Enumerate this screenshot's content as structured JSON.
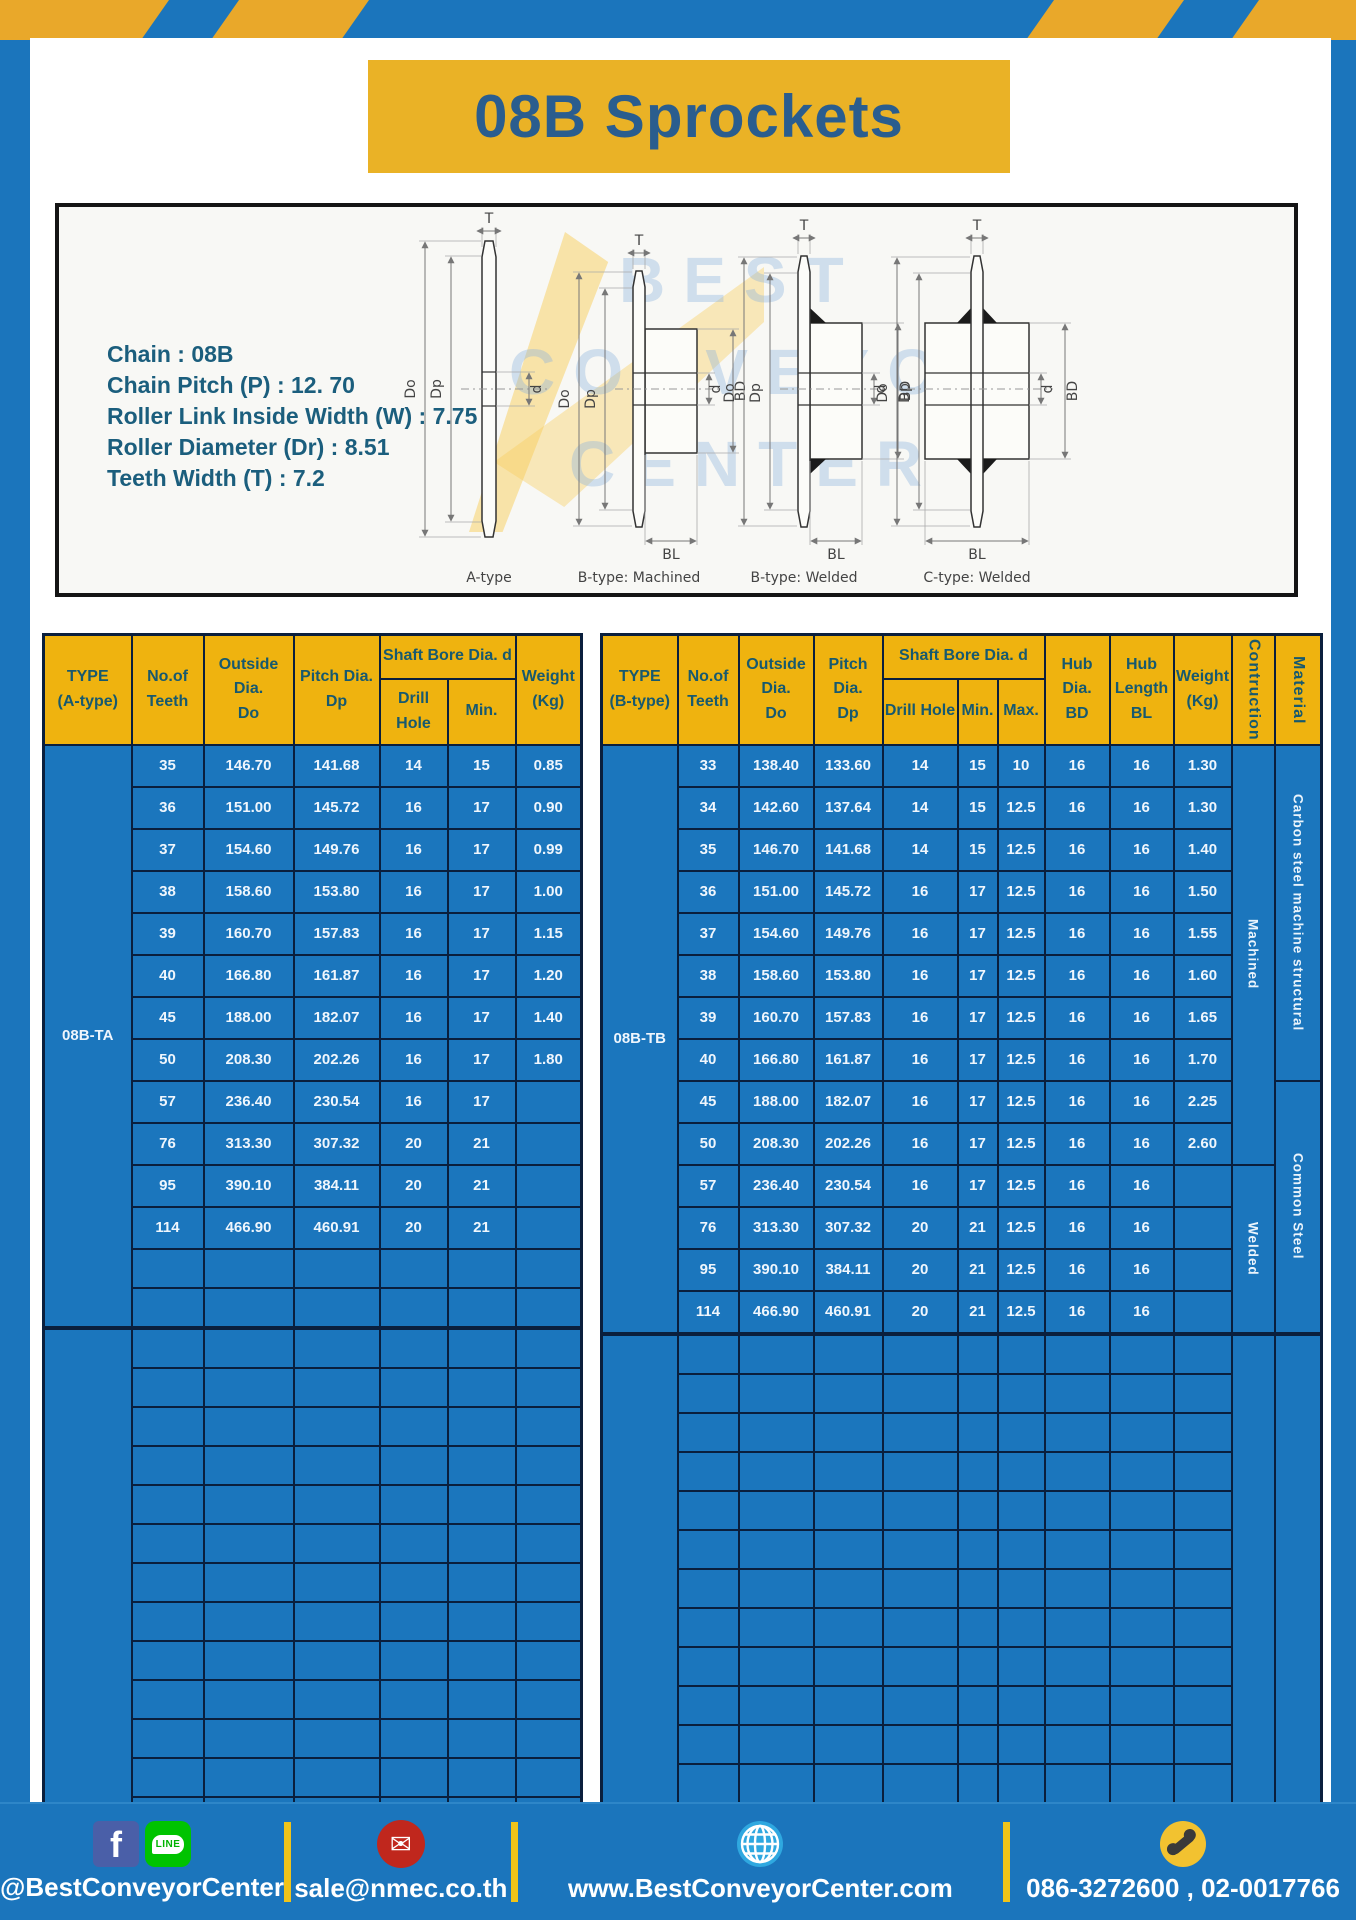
{
  "title": "08B Sprockets",
  "colors": {
    "frame_blue": "#1B75BC",
    "accent_yellow": "#EAB226",
    "table_header_yellow": "#EFB30F",
    "table_body_blue": "#1B76BD",
    "table_border_navy": "#0A1F3D",
    "title_blue": "#2A5D8E",
    "spec_teal": "#1B5E7D",
    "footer_divider_yellow": "#F0C419"
  },
  "specs": {
    "lines": [
      "Chain  : 08B",
      "Chain Pitch (P)  :  12. 70",
      "Roller Link Inside Width (W)  :  7.75",
      "Roller Diameter (Dr)  : 8.51",
      "Teeth Width (T)  :  7.2"
    ]
  },
  "diagram": {
    "captions": [
      "A-type",
      "B-type: Machined",
      "B-type: Welded",
      "C-type: Welded"
    ],
    "dims": {
      "t": "T",
      "do_": "Do",
      "dp": "Dp",
      "d": "d",
      "bd": "BD",
      "bl": "BL"
    },
    "watermark": [
      "BEST",
      "CONVEYOR",
      "CENTER"
    ]
  },
  "left_table": {
    "cols": 6,
    "headers": {
      "type": "TYPE\n(A-type)",
      "teeth": "No.of\nTeeth",
      "outside": "Outside\nDia.\nDo",
      "pitch": "Pitch Dia.\nDp",
      "shaft": "Shaft Bore Dia. d",
      "drill": "Drill Hole",
      "min": "Min.",
      "weight": "Weight\n(Kg)"
    },
    "sections": [
      {
        "type_label": "08B-TA",
        "empty_rows": 2,
        "rows": [
          [
            "35",
            "146.70",
            "141.68",
            "14",
            "15",
            "0.85"
          ],
          [
            "36",
            "151.00",
            "145.72",
            "16",
            "17",
            "0.90"
          ],
          [
            "37",
            "154.60",
            "149.76",
            "16",
            "17",
            "0.99"
          ],
          [
            "38",
            "158.60",
            "153.80",
            "16",
            "17",
            "1.00"
          ],
          [
            "39",
            "160.70",
            "157.83",
            "16",
            "17",
            "1.15"
          ],
          [
            "40",
            "166.80",
            "161.87",
            "16",
            "17",
            "1.20"
          ],
          [
            "45",
            "188.00",
            "182.07",
            "16",
            "17",
            "1.40"
          ],
          [
            "50",
            "208.30",
            "202.26",
            "16",
            "17",
            "1.80"
          ],
          [
            "57",
            "236.40",
            "230.54",
            "16",
            "17",
            ""
          ],
          [
            "76",
            "313.30",
            "307.32",
            "20",
            "21",
            ""
          ],
          [
            "95",
            "390.10",
            "384.11",
            "20",
            "21",
            ""
          ],
          [
            "114",
            "466.90",
            "460.91",
            "20",
            "21",
            ""
          ]
        ]
      },
      {
        "type_label": "",
        "empty_rows": 13,
        "rows": []
      }
    ]
  },
  "right_table": {
    "cols": 9,
    "headers": {
      "type": "TYPE\n(B-type)",
      "teeth": "No.of\nTeeth",
      "outside": "Outside\nDia.\nDo",
      "pitch": "Pitch Dia.\nDp",
      "shaft": "Shaft Bore Dia. d",
      "drill": "Drill Hole",
      "min": "Min.",
      "max": "Max.",
      "hub_dia": "Hub Dia.\nBD",
      "hub_len": "Hub\nLength\nBL",
      "weight": "Weight\n(Kg)",
      "construction": "Contruction",
      "material": "Material"
    },
    "sections": [
      {
        "type_label": "08B-TB",
        "empty_rows": 0,
        "rows": [
          [
            "33",
            "138.40",
            "133.60",
            "14",
            "15",
            "10",
            "16",
            "16",
            "1.30"
          ],
          [
            "34",
            "142.60",
            "137.64",
            "14",
            "15",
            "12.5",
            "16",
            "16",
            "1.30"
          ],
          [
            "35",
            "146.70",
            "141.68",
            "14",
            "15",
            "12.5",
            "16",
            "16",
            "1.40"
          ],
          [
            "36",
            "151.00",
            "145.72",
            "16",
            "17",
            "12.5",
            "16",
            "16",
            "1.50"
          ],
          [
            "37",
            "154.60",
            "149.76",
            "16",
            "17",
            "12.5",
            "16",
            "16",
            "1.55"
          ],
          [
            "38",
            "158.60",
            "153.80",
            "16",
            "17",
            "12.5",
            "16",
            "16",
            "1.60"
          ],
          [
            "39",
            "160.70",
            "157.83",
            "16",
            "17",
            "12.5",
            "16",
            "16",
            "1.65"
          ],
          [
            "40",
            "166.80",
            "161.87",
            "16",
            "17",
            "12.5",
            "16",
            "16",
            "1.70"
          ],
          [
            "45",
            "188.00",
            "182.07",
            "16",
            "17",
            "12.5",
            "16",
            "16",
            "2.25"
          ],
          [
            "50",
            "208.30",
            "202.26",
            "16",
            "17",
            "12.5",
            "16",
            "16",
            "2.60"
          ],
          [
            "57",
            "236.40",
            "230.54",
            "16",
            "17",
            "12.5",
            "16",
            "16",
            ""
          ],
          [
            "76",
            "313.30",
            "307.32",
            "20",
            "21",
            "12.5",
            "16",
            "16",
            ""
          ],
          [
            "95",
            "390.10",
            "384.11",
            "20",
            "21",
            "12.5",
            "16",
            "16",
            ""
          ],
          [
            "114",
            "466.90",
            "460.91",
            "20",
            "21",
            "12.5",
            "16",
            "16",
            ""
          ]
        ],
        "construction": [
          {
            "label": "Machined",
            "span": 10
          },
          {
            "label": "Welded",
            "span": 4
          }
        ],
        "material": [
          {
            "label": "Carbon steel  machine structural",
            "span": 8
          },
          {
            "label": "Common  Steel",
            "span": 6
          }
        ]
      },
      {
        "type_label": "",
        "empty_rows": 12,
        "rows": [],
        "construction": [
          {
            "label": "",
            "span": 12
          }
        ],
        "material": [
          {
            "label": "",
            "span": 12
          }
        ]
      }
    ]
  },
  "footer": {
    "facebook_label": "f",
    "line_label": "LINE",
    "social": "@BestConveyorCenter",
    "email": "sale@nmec.co.th",
    "website": "www.BestConveyorCenter.com",
    "phone": "086-3272600 , 02-0017766"
  }
}
